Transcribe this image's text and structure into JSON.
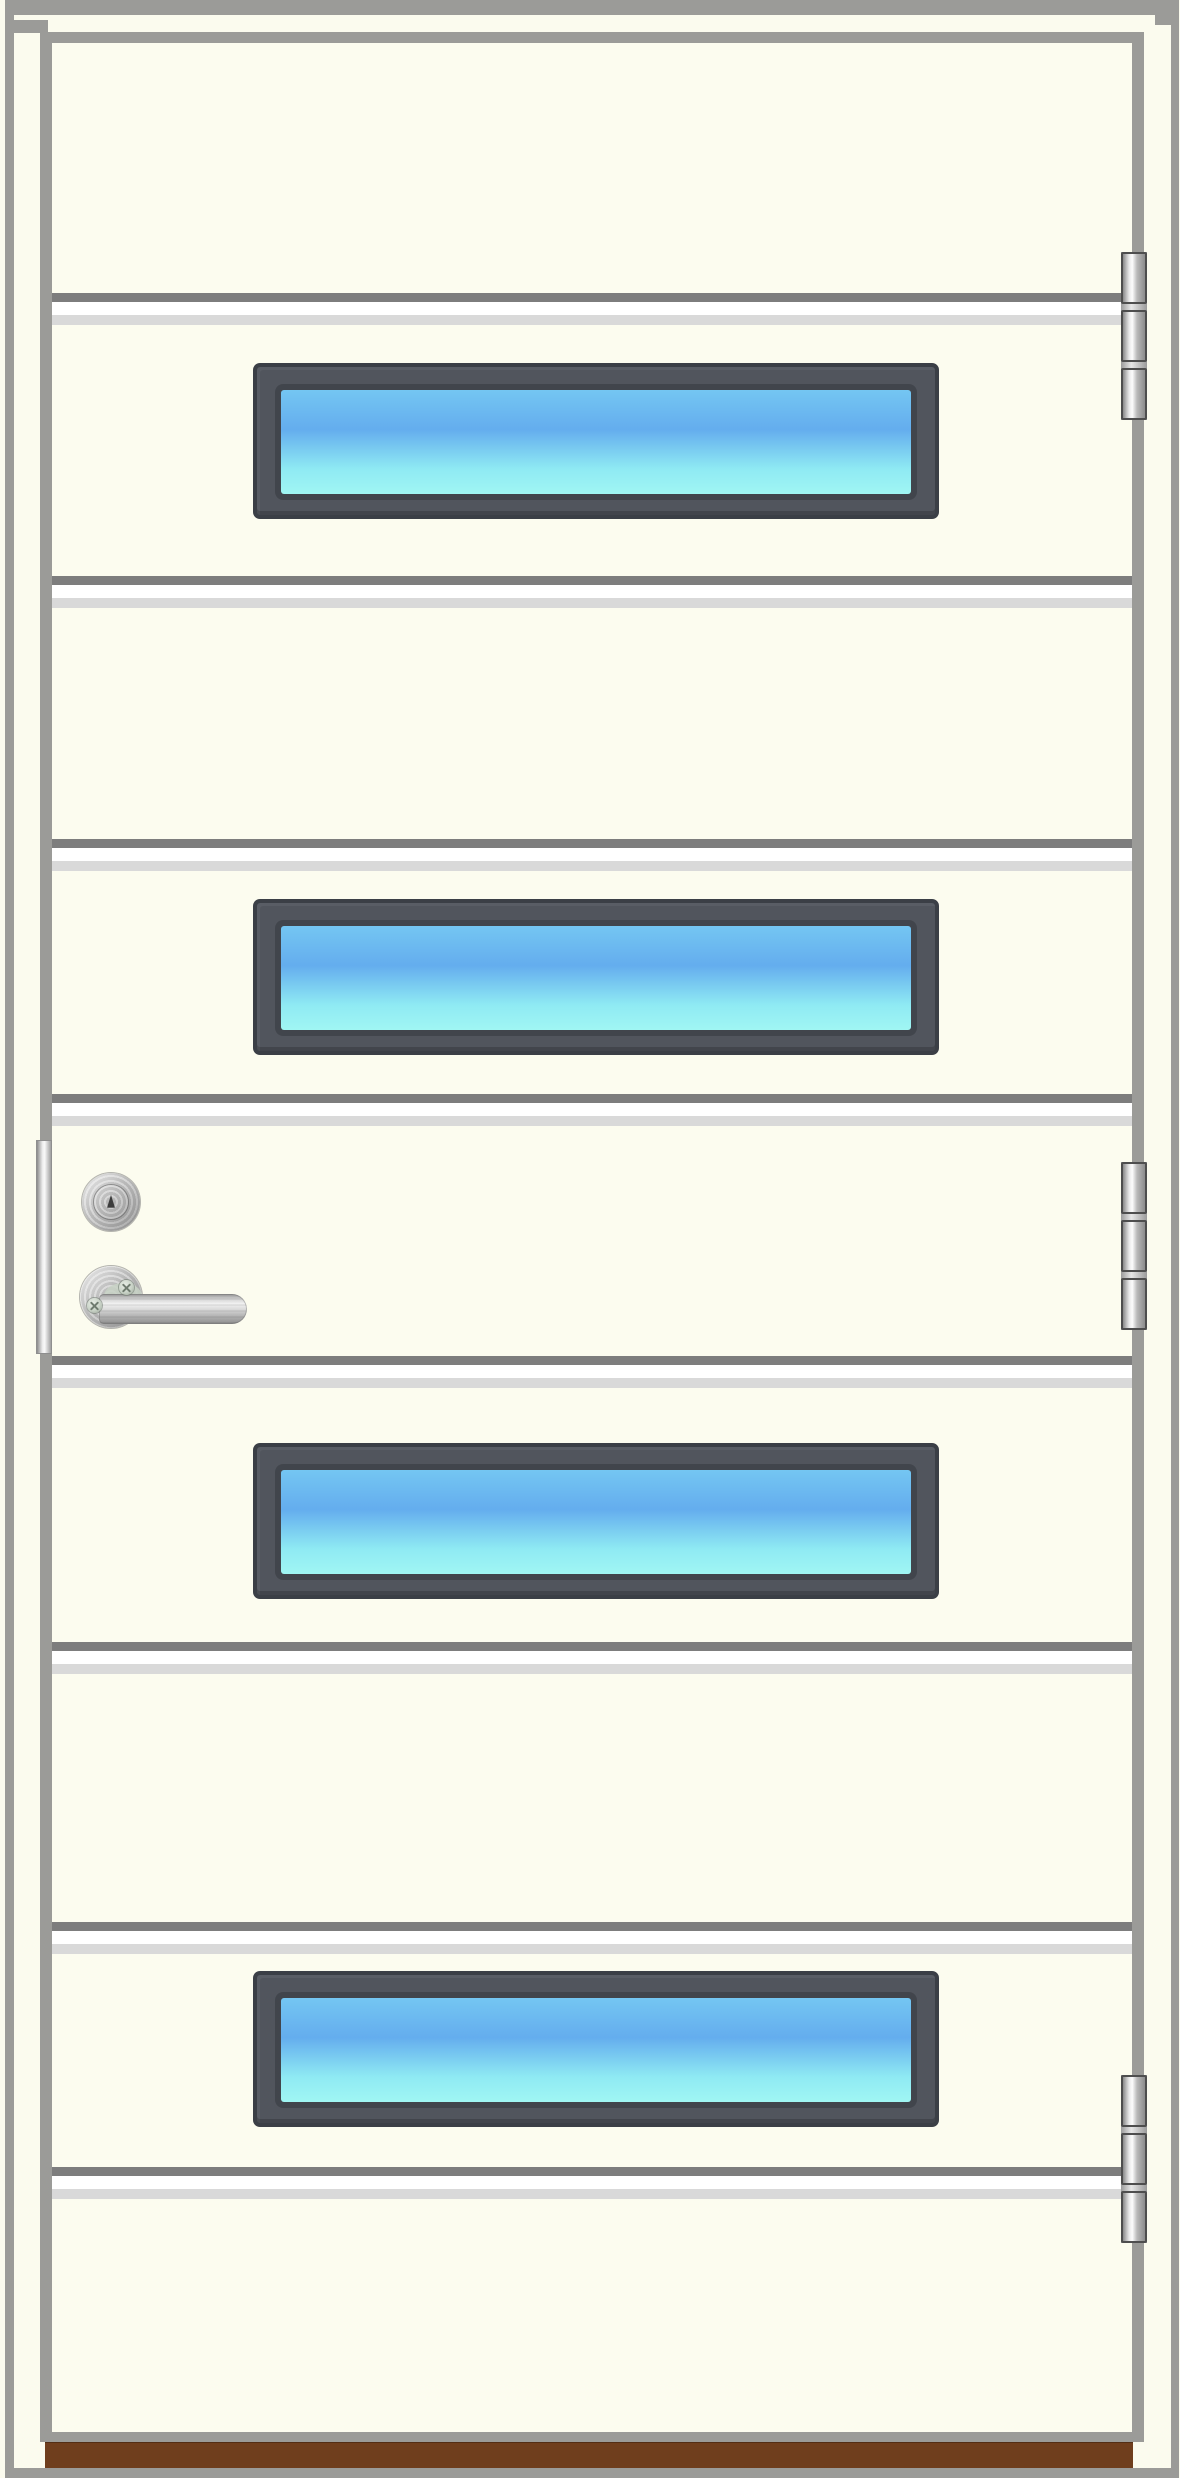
{
  "meta": {
    "description": "Product illustration of an off-white exterior door with nine horizontal panels, four horizontal glazing strips with blue-cyan glass, stainless-steel lever handle, key cylinder and lock faceplate on the left edge, three barrel hinges on the right edge, and a brown wooden threshold",
    "width_px": 1180,
    "height_px": 2478
  },
  "door": {
    "panel_count": 9,
    "horizontal_groove_count": 8,
    "window_count": 4,
    "hinge_count": 3,
    "hinge_knuckles_per_hinge": 3,
    "handle_side": "left",
    "hinge_side": "right",
    "hardware_parts": [
      "lock-faceplate",
      "lock-cylinder",
      "keyhole",
      "handle-rosette",
      "rosette-screws",
      "lever-handle",
      "threshold"
    ]
  },
  "colors": {
    "backdrop": "#FBFBEE",
    "frame-gray": "#9B9B98",
    "door-face": "#FCFCEF",
    "groove-dark": "#7D7D7D",
    "groove-mid": "#FFFFFF",
    "groove-light": "#D9D9D9",
    "window-frame": "#51555D",
    "window-lip": "#3B3F46",
    "window-ring": "#41454C",
    "glass-top": "#74C6F2",
    "glass-mid": "#64ADEE",
    "glass-low": "#8FEAF3",
    "glass-bottom": "#A0F6F3",
    "hinge-outline": "#4E4E4E",
    "keyhole": "#3C3C3C",
    "screw-face": "#C8D2C6",
    "screw-slot": "#6F7B6F",
    "threshold-brown": "#6F3E1D"
  }
}
